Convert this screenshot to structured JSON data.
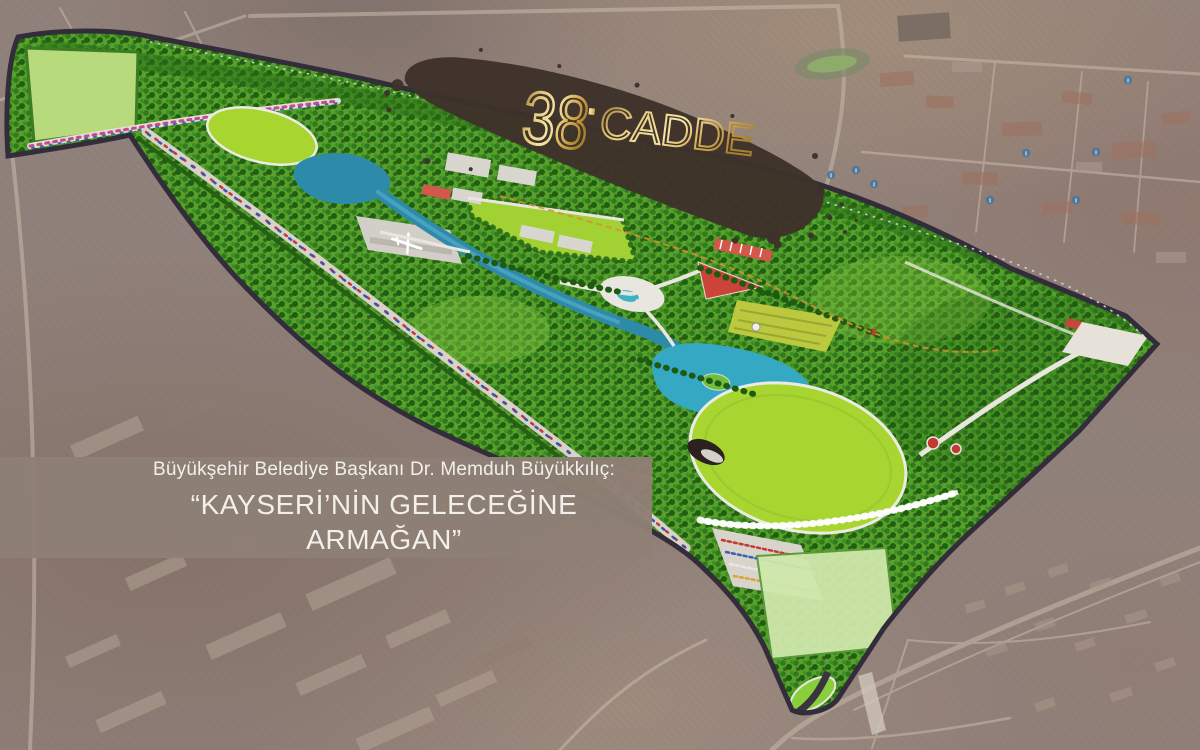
{
  "logo": {
    "number": "38",
    "separator": ".",
    "name": "CADDE"
  },
  "caption": {
    "line1": "Büyükşehir Belediye Başkanı Dr. Memduh Büyükkılıç:",
    "line2": "“KAYSERİ’NİN GELECEĞİNE ARMAĞAN”"
  },
  "map": {
    "info_marker_glyph": "i"
  },
  "colors": {
    "logo_gold": "#d9b867",
    "logo_band_brown": "#3e322a",
    "caption_background": "#8e7f75",
    "caption_text": "#f7f4f0",
    "park_green": "#57a02b",
    "lawn_green": "#a8d52f",
    "meadow_green": "#b6da7c",
    "water_teal": "#2f8fae",
    "path_white": "#e9e6df",
    "accent_red": "#c8433a",
    "boundary_road": "#332c3a",
    "satellite_base": "#98887e"
  }
}
